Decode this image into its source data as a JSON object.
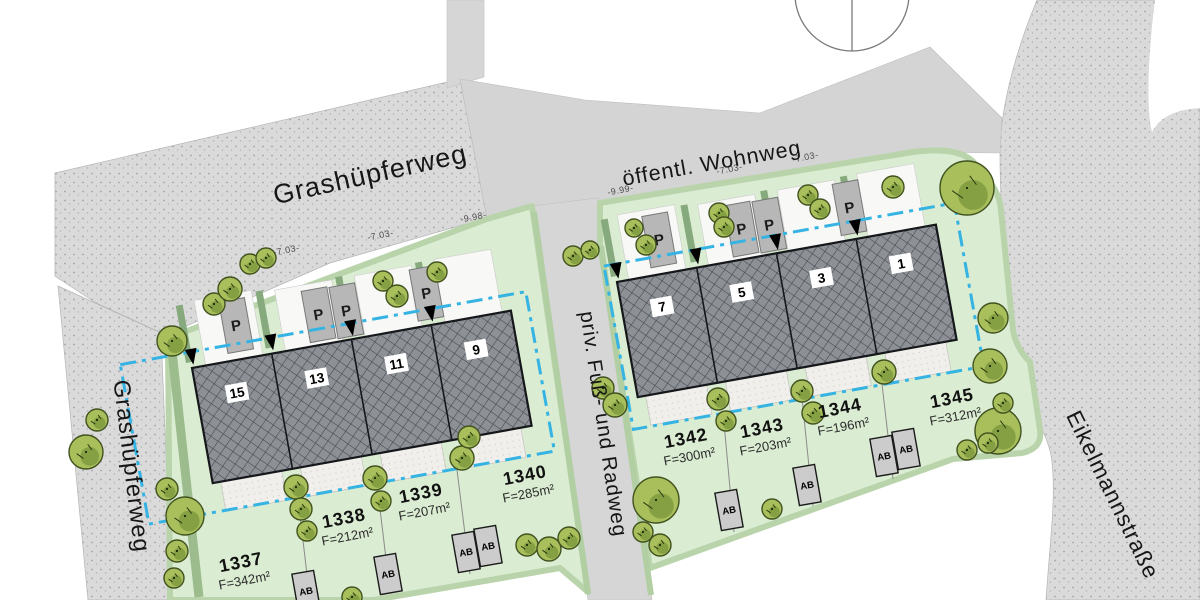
{
  "plan_title": "Lageplan Wohngebiet",
  "streets": {
    "grashuepferweg_top": "Grashüpferweg",
    "grashuepferweg_left": "Grashüpferweg",
    "wohnweg": "öffentl. Wohnweg",
    "radweg": "priv. Fuß- und Radweg",
    "eikelmannstrasse": "Eikelmannstraße"
  },
  "dimensions": {
    "left": [
      "-7.03-",
      "-7.03-",
      "-9.98-"
    ],
    "right": [
      "-9.99-",
      "-7.03-",
      "-7.03-"
    ]
  },
  "blocks": [
    {
      "name": "west-row",
      "house_numbers": [
        "15",
        "13",
        "11",
        "9"
      ]
    },
    {
      "name": "east-row",
      "house_numbers": [
        "7",
        "5",
        "3",
        "1"
      ]
    }
  ],
  "plots": [
    {
      "number": "1337",
      "area": "F=342m²"
    },
    {
      "number": "1338",
      "area": "F=212m²"
    },
    {
      "number": "1339",
      "area": "F=207m²"
    },
    {
      "number": "1340",
      "area": "F=285m²"
    },
    {
      "number": "1342",
      "area": "F=300m²"
    },
    {
      "number": "1343",
      "area": "F=203m²"
    },
    {
      "number": "1344",
      "area": "F=196m²"
    },
    {
      "number": "1345",
      "area": "F=312m²"
    }
  ],
  "markers": {
    "parking": "P",
    "waste": "AB"
  },
  "colors": {
    "road": "#dadada",
    "path": "#d6d6d6",
    "parcel": "#daecd2",
    "parcel_edge": "#b9d4ab",
    "hedge": "#86a97d",
    "building": "#8d9196",
    "building_hatch": "#41454d",
    "baugrenze_blue": "#35b3e3",
    "tree": "#a8bf5c",
    "tree_dark": "#7f9a3e",
    "tree_outline": "#41521f"
  }
}
